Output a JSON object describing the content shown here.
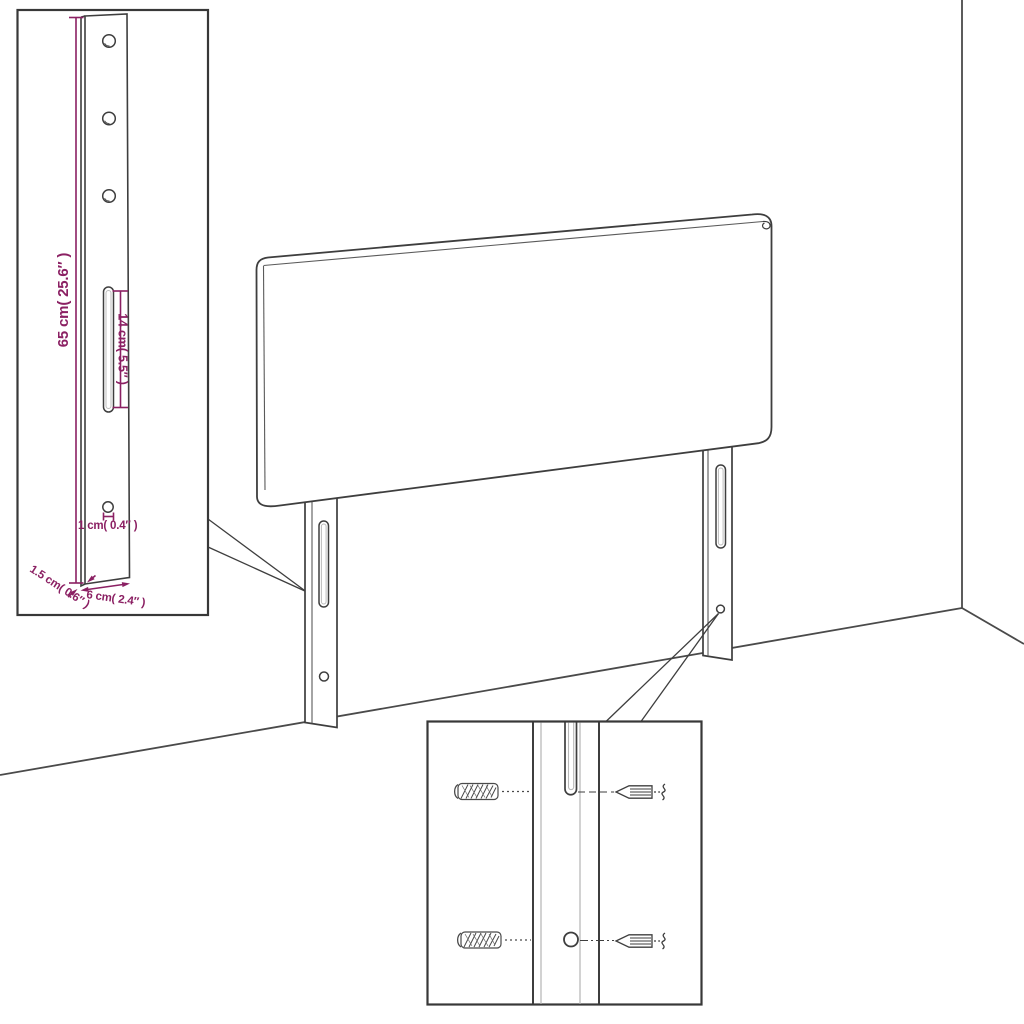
{
  "page": {
    "title": "Headboard with legs — dimension line drawing",
    "background": "#ffffff"
  },
  "colors": {
    "dimension_accent": "#8b2063",
    "line_art": "#3e3e3e",
    "inner_line": "#b4b4b4"
  },
  "leg_detail_inset": {
    "height_label": "65 cm( 25.6″ )",
    "slot_length_label": "14 cm( 5.5″ )",
    "hole_diameter_label": "1 cm( 0.4″ )",
    "thickness_label": "1.5 cm( 0.6″ )",
    "width_label": "6 cm( 2.4″ )"
  },
  "icons": {
    "wall_plug_icon": "hatched-cylinder-screw",
    "screw_icon": "tapered-wood-screw-with-thread-squiggle"
  }
}
